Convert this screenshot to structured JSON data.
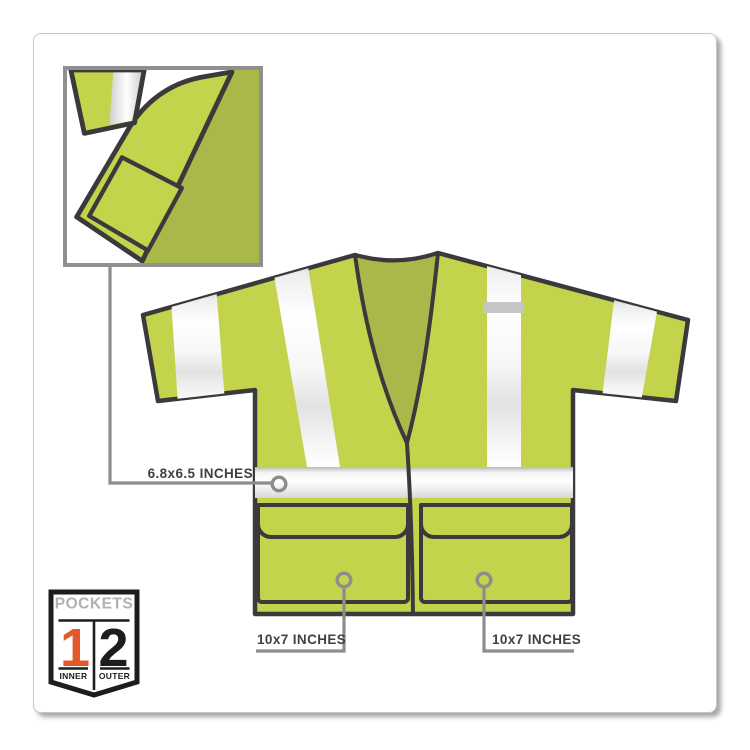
{
  "callouts": {
    "inner_pocket": {
      "label": "6.8x6.5 INCHES"
    },
    "left_pocket": {
      "label": "10x7 INCHES"
    },
    "right_pocket": {
      "label": "10x7 INCHES"
    }
  },
  "badge": {
    "title": "POCKETS",
    "left_value": "1",
    "left_label": "INNER",
    "right_value": "2",
    "right_label": "OUTER"
  },
  "colors": {
    "vest_lime": "#c3d34b",
    "vest_inner_green": "#a9b848",
    "outline_dark": "#3a3a3c",
    "reflective_silver": "#f2f2f2",
    "leader_gray": "#8d8d8d",
    "badge_tab_gray": "#c5c5c6",
    "label_text": "#414042",
    "badge_orange": "#e2572b",
    "badge_black": "#1d1d1b",
    "badge_title_gray": "#b1b1b3"
  }
}
